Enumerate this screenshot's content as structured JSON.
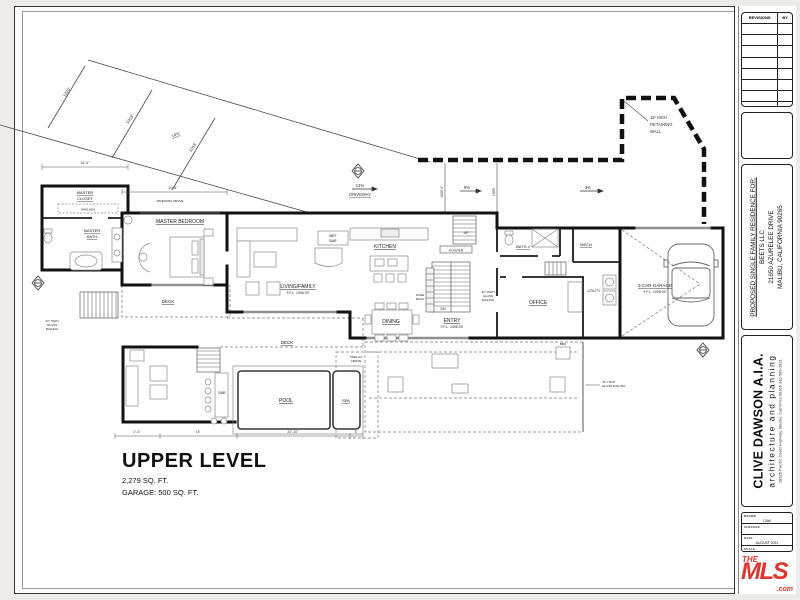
{
  "header": {
    "title": "UPPER LEVEL",
    "area": "2,279 SQ. FT.",
    "garage_area": "GARAGE: 500 SQ. FT."
  },
  "titleblock": {
    "revisions_header": "REVISIONS",
    "by_header": "BY",
    "project": {
      "line1": "PROPOSED SINGLE FAMILY RESIDENCE FOR:",
      "line2": "BEETS LLC",
      "line3": "21650 AZURELEE DRIVE",
      "line4": "MALIBU, CALIFORNIA 90265"
    },
    "firm": {
      "name": "CLIVE DAWSON A.I.A.",
      "tagline": "architecture and planning",
      "address": "28925 Pacific Coast Highway, Malibu, California 90265  310-589-1921"
    },
    "info_rows": [
      {
        "label": "DRAWN",
        "value": "CAW"
      },
      {
        "label": "CHECKED",
        "value": ""
      },
      {
        "label": "DATE",
        "value": "AUGUST 2021"
      },
      {
        "label": "SCALE",
        "value": "1/4\" = 1'-0\""
      }
    ],
    "logo": {
      "the": "THE",
      "mls": "MLS",
      "reg": "®",
      "com": ".com",
      "color": "#e0352f"
    }
  },
  "plan": {
    "labels": {
      "master1": "MASTER",
      "closet": "CLOSET",
      "shelves": "SHELVES",
      "bath": "BATH",
      "master_bedroom": "MASTER BEDROOM",
      "deck": "DECK",
      "living": "LIVING/FAMILY",
      "ffl_1006": "F.F.L. 1006.00'",
      "wet": "WET",
      "bar": "BAR",
      "kitchen": "KITCHEN",
      "dining": "DINING",
      "wine": "WINE",
      "rack": "RACK",
      "entry": "ENTRY",
      "planter": "PLANTER",
      "up": "UP",
      "dn": "DN",
      "bath4": "BATH 4",
      "mech": "MECH",
      "office": "OFFICE",
      "utility": "UTILITY",
      "garage": "3-CAR GARAGE",
      "ffl_1008": "F.F.L. 1008.00'",
      "pool": "POOL",
      "spa": "SPA",
      "trellis1": "TRELLIS",
      "trellis2": "ABOVE",
      "bbq": "BBQ",
      "rail1": "42\" HIGH",
      "rail2": "GLASS",
      "rail3": "RAILING",
      "rail_gr": "GLASS RAILING",
      "windows_above": "WINDOWS ABOVE"
    },
    "site": {
      "c1020": "1020'",
      "c1018": "1018'",
      "c1016": "1016'",
      "slope14": "14%",
      "slope8": "8%",
      "slope3": "3%",
      "driveway": "DRIVEWAY",
      "el1009_4": "1009.4'",
      "el1009": "1009'",
      "ret1": "18' HIGH",
      "ret2": "RETAINING",
      "ret3": "WALL"
    },
    "dims": {
      "d16_6": "16'-6\"",
      "d20_6": "20'-6\"",
      "d2_4": "2'-4\"",
      "d14": "14'",
      "d20_10": "20'-10\"",
      "d5": "5'"
    }
  }
}
